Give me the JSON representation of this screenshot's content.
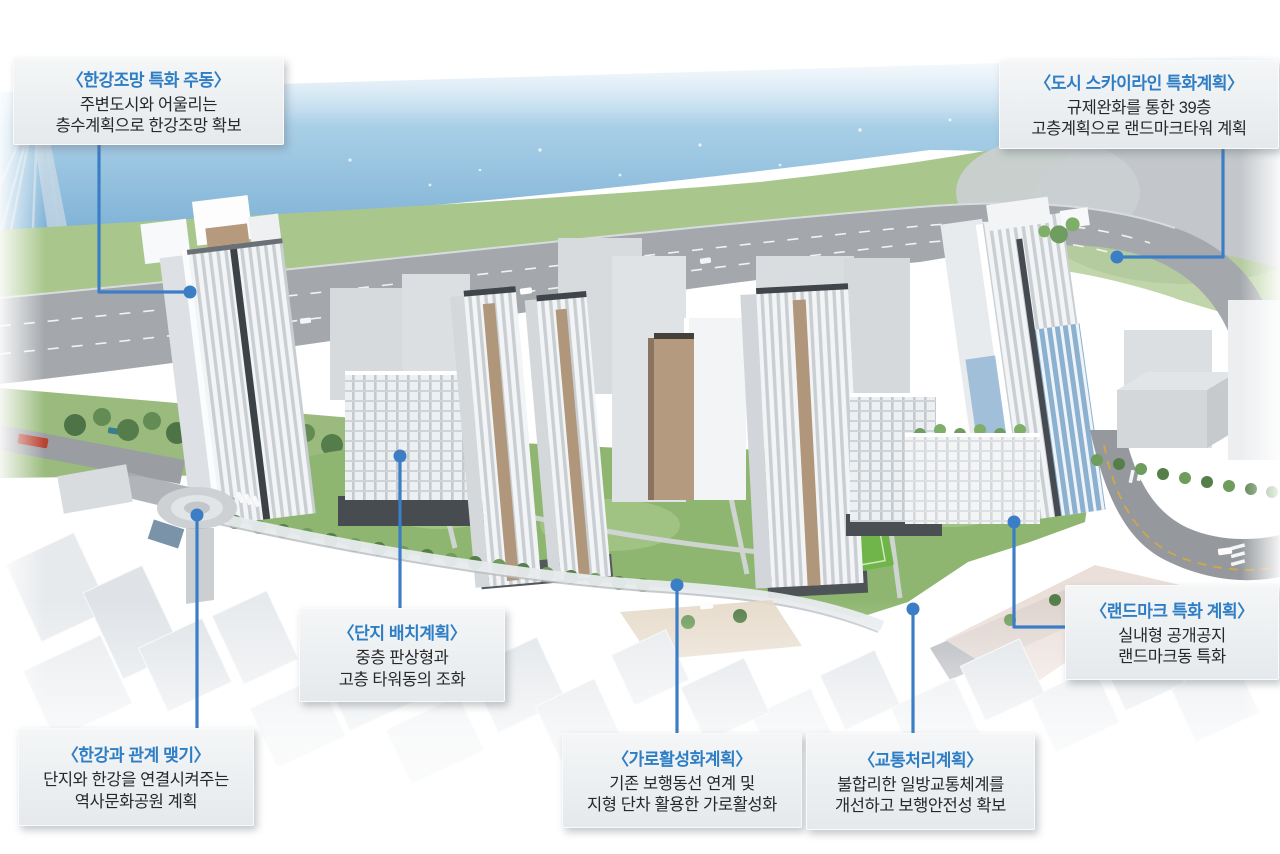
{
  "colors": {
    "leader_line": "#3c7ec6",
    "anchor_dot": "#3c7ec6",
    "callout_title": "#2e7ec6",
    "callout_body": "#26282a",
    "callout_background": "#edf0f2"
  },
  "annotations": [
    {
      "id": "hangang-view-tower",
      "title": "〈한강조망 특화 주동〉",
      "body": "주변도시와 어울리는\n층수계획으로 한강조망 확보"
    },
    {
      "id": "city-skyline",
      "title": "〈도시 스카이라인 특화계획〉",
      "body": "규제완화를 통한 39층\n고층계획으로 랜드마크타워 계획"
    },
    {
      "id": "site-layout",
      "title": "〈단지 배치계획〉",
      "body": "중층 판상형과\n고층 타워동의 조화"
    },
    {
      "id": "hangang-connection",
      "title": "〈한강과 관계 맺기〉",
      "body": "단지와 한강을 연결시켜주는\n역사문화공원 계획"
    },
    {
      "id": "street-activation",
      "title": "〈가로활성화계획〉",
      "body": "기존 보행동선 연계 및\n지형 단차 활용한 가로활성화"
    },
    {
      "id": "traffic-plan",
      "title": "〈교통처리계획〉",
      "body": "불합리한 일방교통체계를\n개선하고 보행안전성 확보"
    },
    {
      "id": "landmark-plan",
      "title": "〈랜드마크 특화 계획〉",
      "body": "실내형 공개공지\n랜드마크동 특화"
    }
  ]
}
